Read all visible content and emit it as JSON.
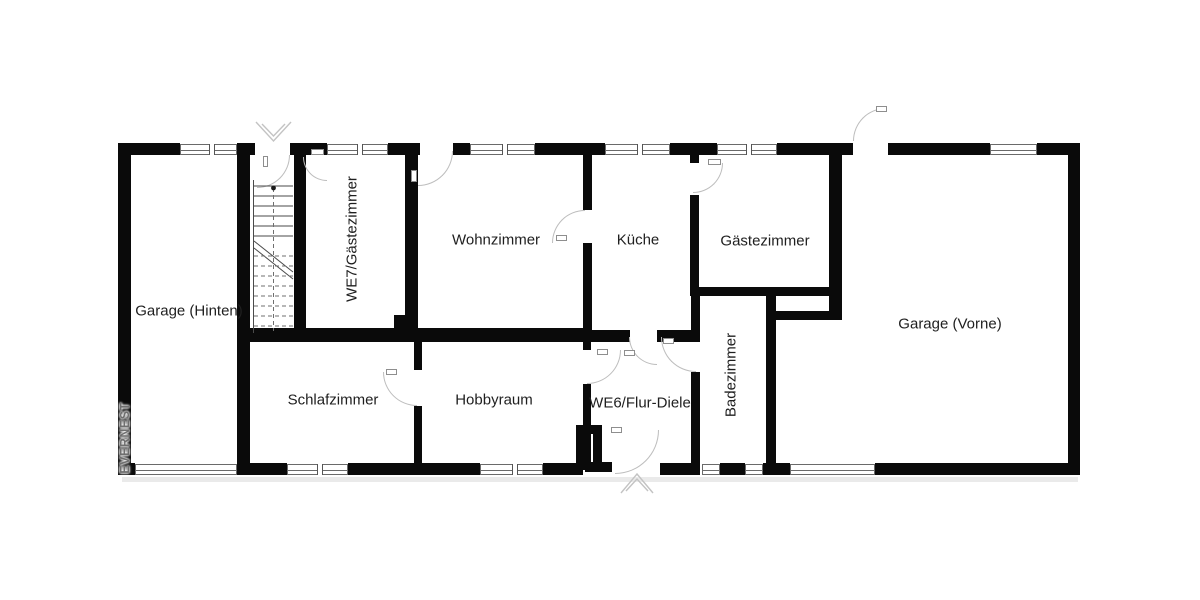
{
  "watermark": "EVERNEST",
  "rooms": {
    "garage_hinten": "Garage (Hinten)",
    "we7": "WE7/Gästezimmer",
    "wohnzimmer": "Wohnzimmer",
    "kueche": "Küche",
    "gaestezimmer": "Gästezimmer",
    "garage_vorne": "Garage (Vorne)",
    "schlafzimmer": "Schlafzimmer",
    "hobbyraum": "Hobbyraum",
    "we6": "WE6/Flur-Diele",
    "badezimmer": "Badezimmer"
  },
  "colors": {
    "wall": "#0a0a0a",
    "door_arc": "#bdbdbd",
    "label": "#1f1f1f",
    "watermark": "#6f6f6f",
    "background": "#ffffff"
  }
}
